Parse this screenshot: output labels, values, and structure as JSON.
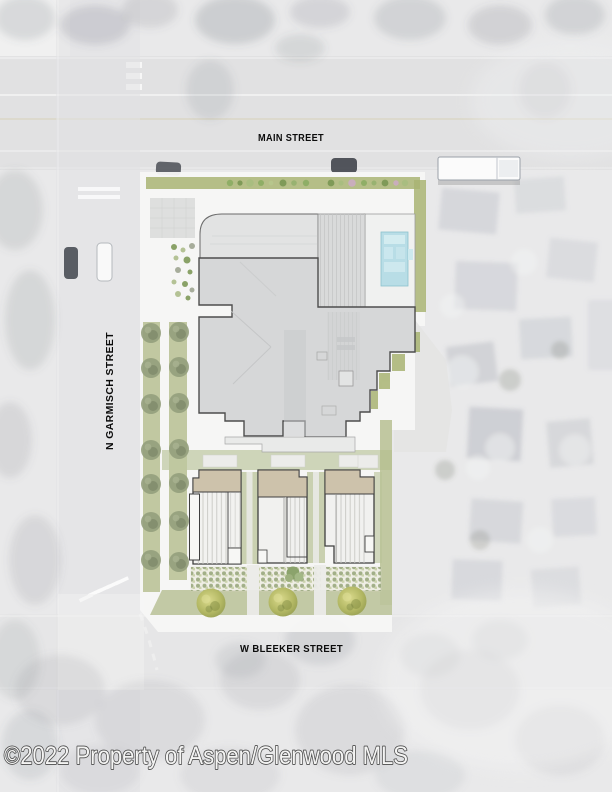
{
  "map": {
    "type": "architectural site plan over aerial photo",
    "streets": {
      "main": "MAIN STREET",
      "garmisch": "N GARMISCH STREET",
      "bleeker": "W BLEEKER STREET"
    }
  },
  "watermark": "©2022 Property of Aspen/Glenwood MLS",
  "colors": {
    "plan_green": "#a9b473",
    "lawn_green": "#bcc49c",
    "tree_olive": "#949e7c",
    "pool_blue": "#b8dde6",
    "building_gray": "#d6d7d8",
    "townhouse_tan": "#cdc2ab",
    "outline_dark": "#4d4d4d"
  }
}
